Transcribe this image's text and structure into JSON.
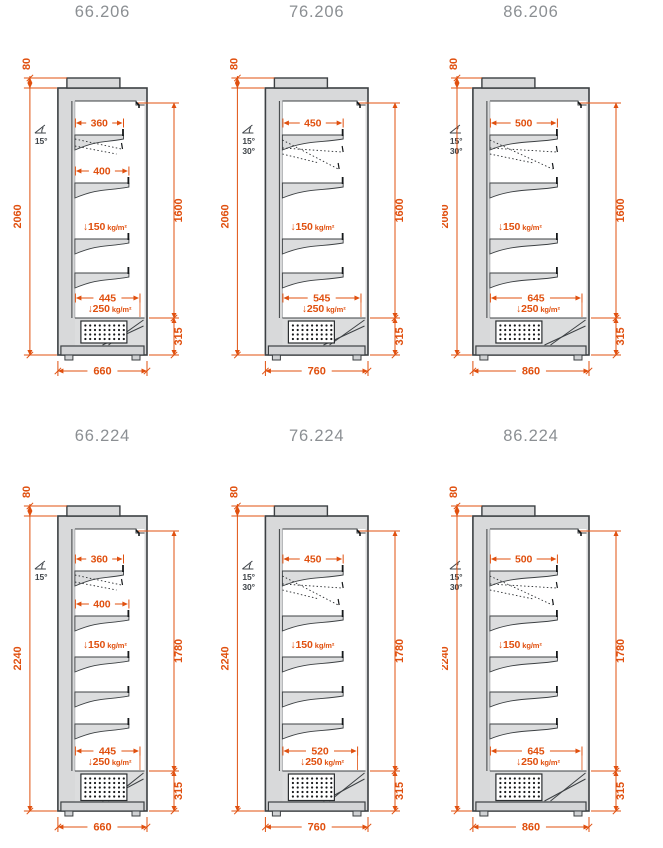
{
  "sheet": {
    "background": "#ffffff"
  },
  "colors": {
    "dimension": "#e0500f",
    "title": "#8b8f93",
    "outline": "#3c4043",
    "cabinet_fill": "#d8d9da",
    "shelf_fill": "#dcddde",
    "plinth_fill": "#d3d4d6",
    "interior": "#ffffff",
    "angle_text": "#3f4449"
  },
  "panels": [
    {
      "title": "66.206",
      "dims": {
        "top_height": "80",
        "total_height": "2060",
        "front_height": "1600",
        "base_height": "315",
        "width": "660",
        "shelf_depths": [
          "360",
          "400"
        ],
        "base_depth": "445",
        "shelf_load": "↓150",
        "base_load": "↓250",
        "load_unit": "kg/m²"
      },
      "angles": [
        "15°"
      ],
      "shelf_count": 4
    },
    {
      "title": "76.206",
      "dims": {
        "top_height": "80",
        "total_height": "2060",
        "front_height": "1600",
        "base_height": "315",
        "width": "760",
        "shelf_depths": [
          "450"
        ],
        "base_depth": "545",
        "shelf_load": "↓150",
        "base_load": "↓250",
        "load_unit": "kg/m²"
      },
      "angles": [
        "15°",
        "30°"
      ],
      "shelf_count": 4
    },
    {
      "title": "86.206",
      "dims": {
        "top_height": "80",
        "total_height": "2060",
        "front_height": "1600",
        "base_height": "315",
        "width": "860",
        "shelf_depths": [
          "500"
        ],
        "base_depth": "645",
        "shelf_load": "↓150",
        "base_load": "↓250",
        "load_unit": "kg/m²"
      },
      "angles": [
        "15°",
        "30°"
      ],
      "shelf_count": 4
    },
    {
      "title": "66.224",
      "dims": {
        "top_height": "80",
        "total_height": "2240",
        "front_height": "1780",
        "base_height": "315",
        "width": "660",
        "shelf_depths": [
          "360",
          "400"
        ],
        "base_depth": "445",
        "shelf_load": "↓150",
        "base_load": "↓250",
        "load_unit": "kg/m²"
      },
      "angles": [
        "15°"
      ],
      "shelf_count": 5
    },
    {
      "title": "76.224",
      "dims": {
        "top_height": "80",
        "total_height": "2240",
        "front_height": "1780",
        "base_height": "315",
        "width": "760",
        "shelf_depths": [
          "450"
        ],
        "base_depth": "520",
        "shelf_load": "↓150",
        "base_load": "↓250",
        "load_unit": "kg/m²"
      },
      "angles": [
        "15°",
        "30°"
      ],
      "shelf_count": 5
    },
    {
      "title": "86.224",
      "dims": {
        "top_height": "80",
        "total_height": "2240",
        "front_height": "1780",
        "base_height": "315",
        "width": "860",
        "shelf_depths": [
          "500"
        ],
        "base_depth": "645",
        "shelf_load": "↓150",
        "base_load": "↓250",
        "load_unit": "kg/m²"
      },
      "angles": [
        "15°",
        "30°"
      ],
      "shelf_count": 5
    }
  ]
}
